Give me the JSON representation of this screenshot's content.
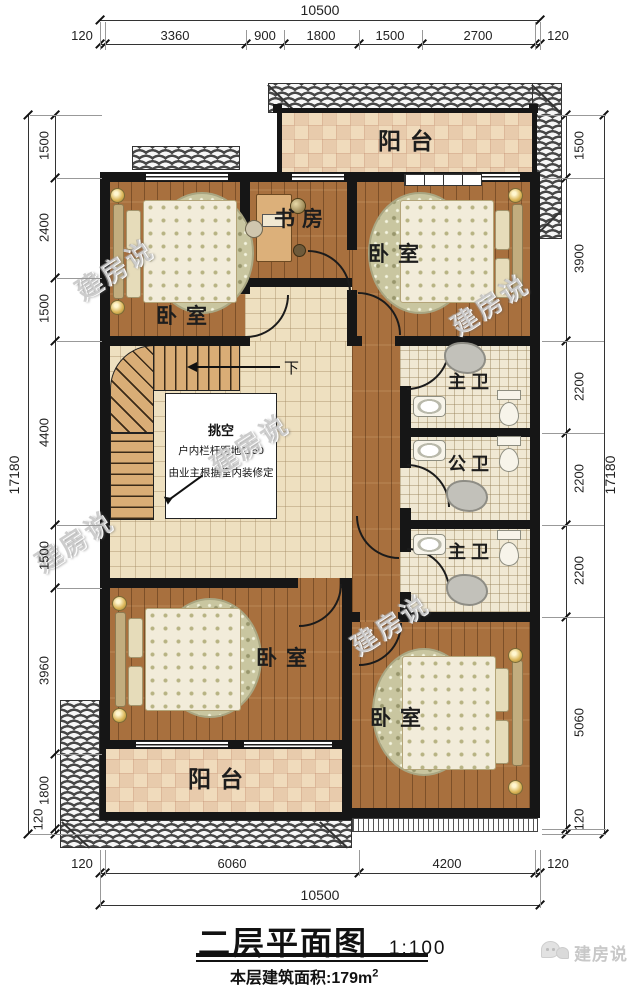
{
  "watermark": "建房说",
  "logo": {
    "text": "建房说"
  },
  "title": {
    "text": "二层平面图",
    "scale": "1:100"
  },
  "area": {
    "label": "本层建筑面积:",
    "value": "179m",
    "sup": "2"
  },
  "dims": {
    "top_total": "10500",
    "top": [
      "120",
      "3360",
      "900",
      "1800",
      "1500",
      "2700",
      "120"
    ],
    "bottom": [
      "120",
      "6060",
      "4200",
      "120"
    ],
    "bottom_total": "10500",
    "left": [
      "1500",
      "2400",
      "1500",
      "4400",
      "1500",
      "3960",
      "1800",
      "120"
    ],
    "left_total": "17180",
    "right": [
      "1500",
      "3900",
      "2200",
      "2200",
      "2200",
      "5060",
      "120"
    ],
    "right_total": "17180"
  },
  "rooms": {
    "balcony_top": "阳台",
    "study": "书房",
    "bedroom_tr": "卧室",
    "bedroom_tl": "卧室",
    "bath_top": "主卫",
    "bath_mid": "公卫",
    "bath_bottom": "主卫",
    "bedroom_bl": "卧室",
    "bedroom_br": "卧室",
    "balcony_bottom": "阳台"
  },
  "notes": {
    "void1": "挑空",
    "void2": "户内栏杆距地1150",
    "void3": "由业主根据室内装修定",
    "down": "下"
  }
}
